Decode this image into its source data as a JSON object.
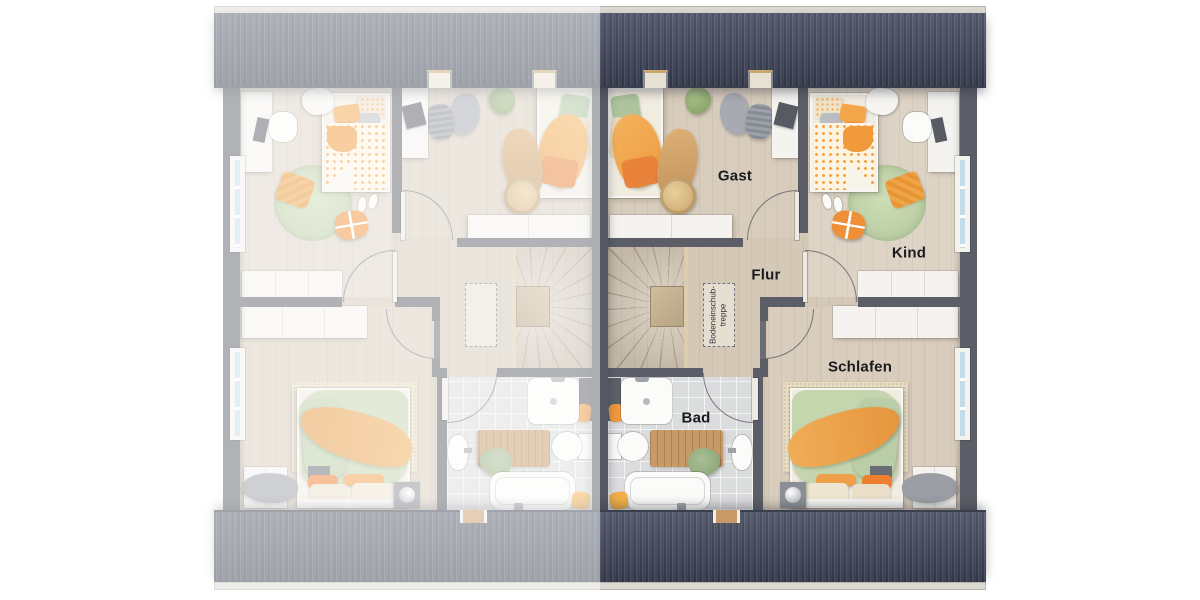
{
  "floorplan": {
    "room_labels": {
      "guest": "Gast",
      "child": "Kind",
      "hallway": "Flur",
      "bedroom": "Schlafen",
      "bathroom": "Bad"
    },
    "attic_hatch_label": {
      "line1": "Bodeneinschub-",
      "line2": "treppe"
    }
  },
  "colors": {
    "roof": "#464b5e",
    "roof_ridge": "#dcdad3",
    "wall": "#5b5e66",
    "party_wall": "#565961",
    "floor_wood": "#d4c8b7",
    "floor_tile": "#dbdcde",
    "accent_orange": "#f0a04b",
    "accent_orange_deep": "#e9823a",
    "accent_green": "#b6cba3",
    "accent_beige": "#e9ddc4",
    "wood": "#c89a67",
    "window_glass": "#c4dcea",
    "label_text": "#1a1b1e",
    "fade_overlay": "rgba(255,255,255,0.52)"
  }
}
